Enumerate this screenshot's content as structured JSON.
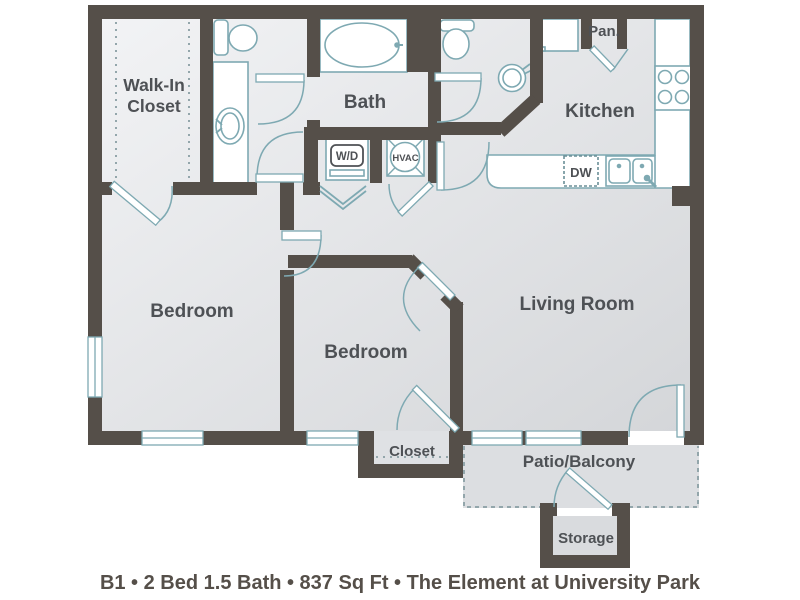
{
  "caption": "B1 • 2 Bed 1.5 Bath • 837 Sq Ft • The Element at University Park",
  "rooms": {
    "walk_in_closet": {
      "line1": "Walk-In",
      "line2": "Closet"
    },
    "bath": "Bath",
    "pantry": "Pan.",
    "kitchen": "Kitchen",
    "bedroom_master": "Bedroom",
    "bedroom_second": "Bedroom",
    "living_room": "Living Room",
    "closet": "Closet",
    "patio": "Patio/Balcony",
    "storage": "Storage"
  },
  "appliances": {
    "washer_dryer": "W/D",
    "hvac": "HVAC",
    "dishwasher": "DW"
  },
  "colors": {
    "wall": "#554f49",
    "fixture_line": "#7ea9b2",
    "dashed_line": "#93a6ab",
    "label_text": "#4e5155",
    "room_fill_light": "#f1f2f4",
    "room_fill_dark": "#d5d7da",
    "outdoor_fill": "#dcdee1",
    "background": "#ffffff"
  }
}
